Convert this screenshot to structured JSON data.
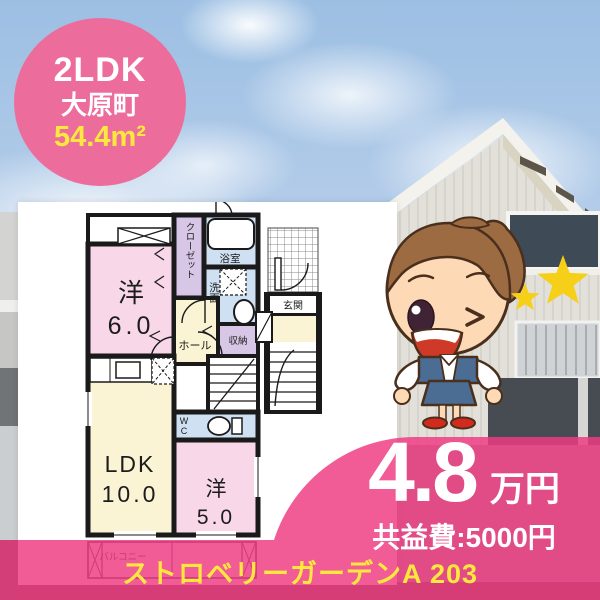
{
  "badge": {
    "layout": "2LDK",
    "town": "大原町",
    "area": "54.4m²"
  },
  "floor_plan": {
    "room_west1_label": "洋",
    "room_west1_size": "6.0",
    "closet": "クローゼット",
    "bath": "浴室",
    "washroom": "洗面",
    "hall": "ホール",
    "storage": "収納",
    "ldk_label": "LDK",
    "ldk_size": "10.0",
    "room_west2_label": "洋",
    "room_west2_size": "5.0",
    "wc": "WC",
    "entrance": "玄関",
    "balcony": "バルコニー"
  },
  "price": {
    "rent": "4.8",
    "unit": "万円",
    "common_fee": "共益費:5000円"
  },
  "footer": {
    "property_name": "ストロベリーガーデンA 203"
  },
  "colors": {
    "accent_pink": "#ee3c82",
    "badge_pink": "#ec6d9b",
    "highlight_yellow": "#ffe83d",
    "room_pink": "#f8d7e8",
    "room_cream": "#faf3d4",
    "room_blue": "#cfe0f2",
    "room_purple": "#d7c6e6",
    "wall_black": "#1a1a1a"
  }
}
